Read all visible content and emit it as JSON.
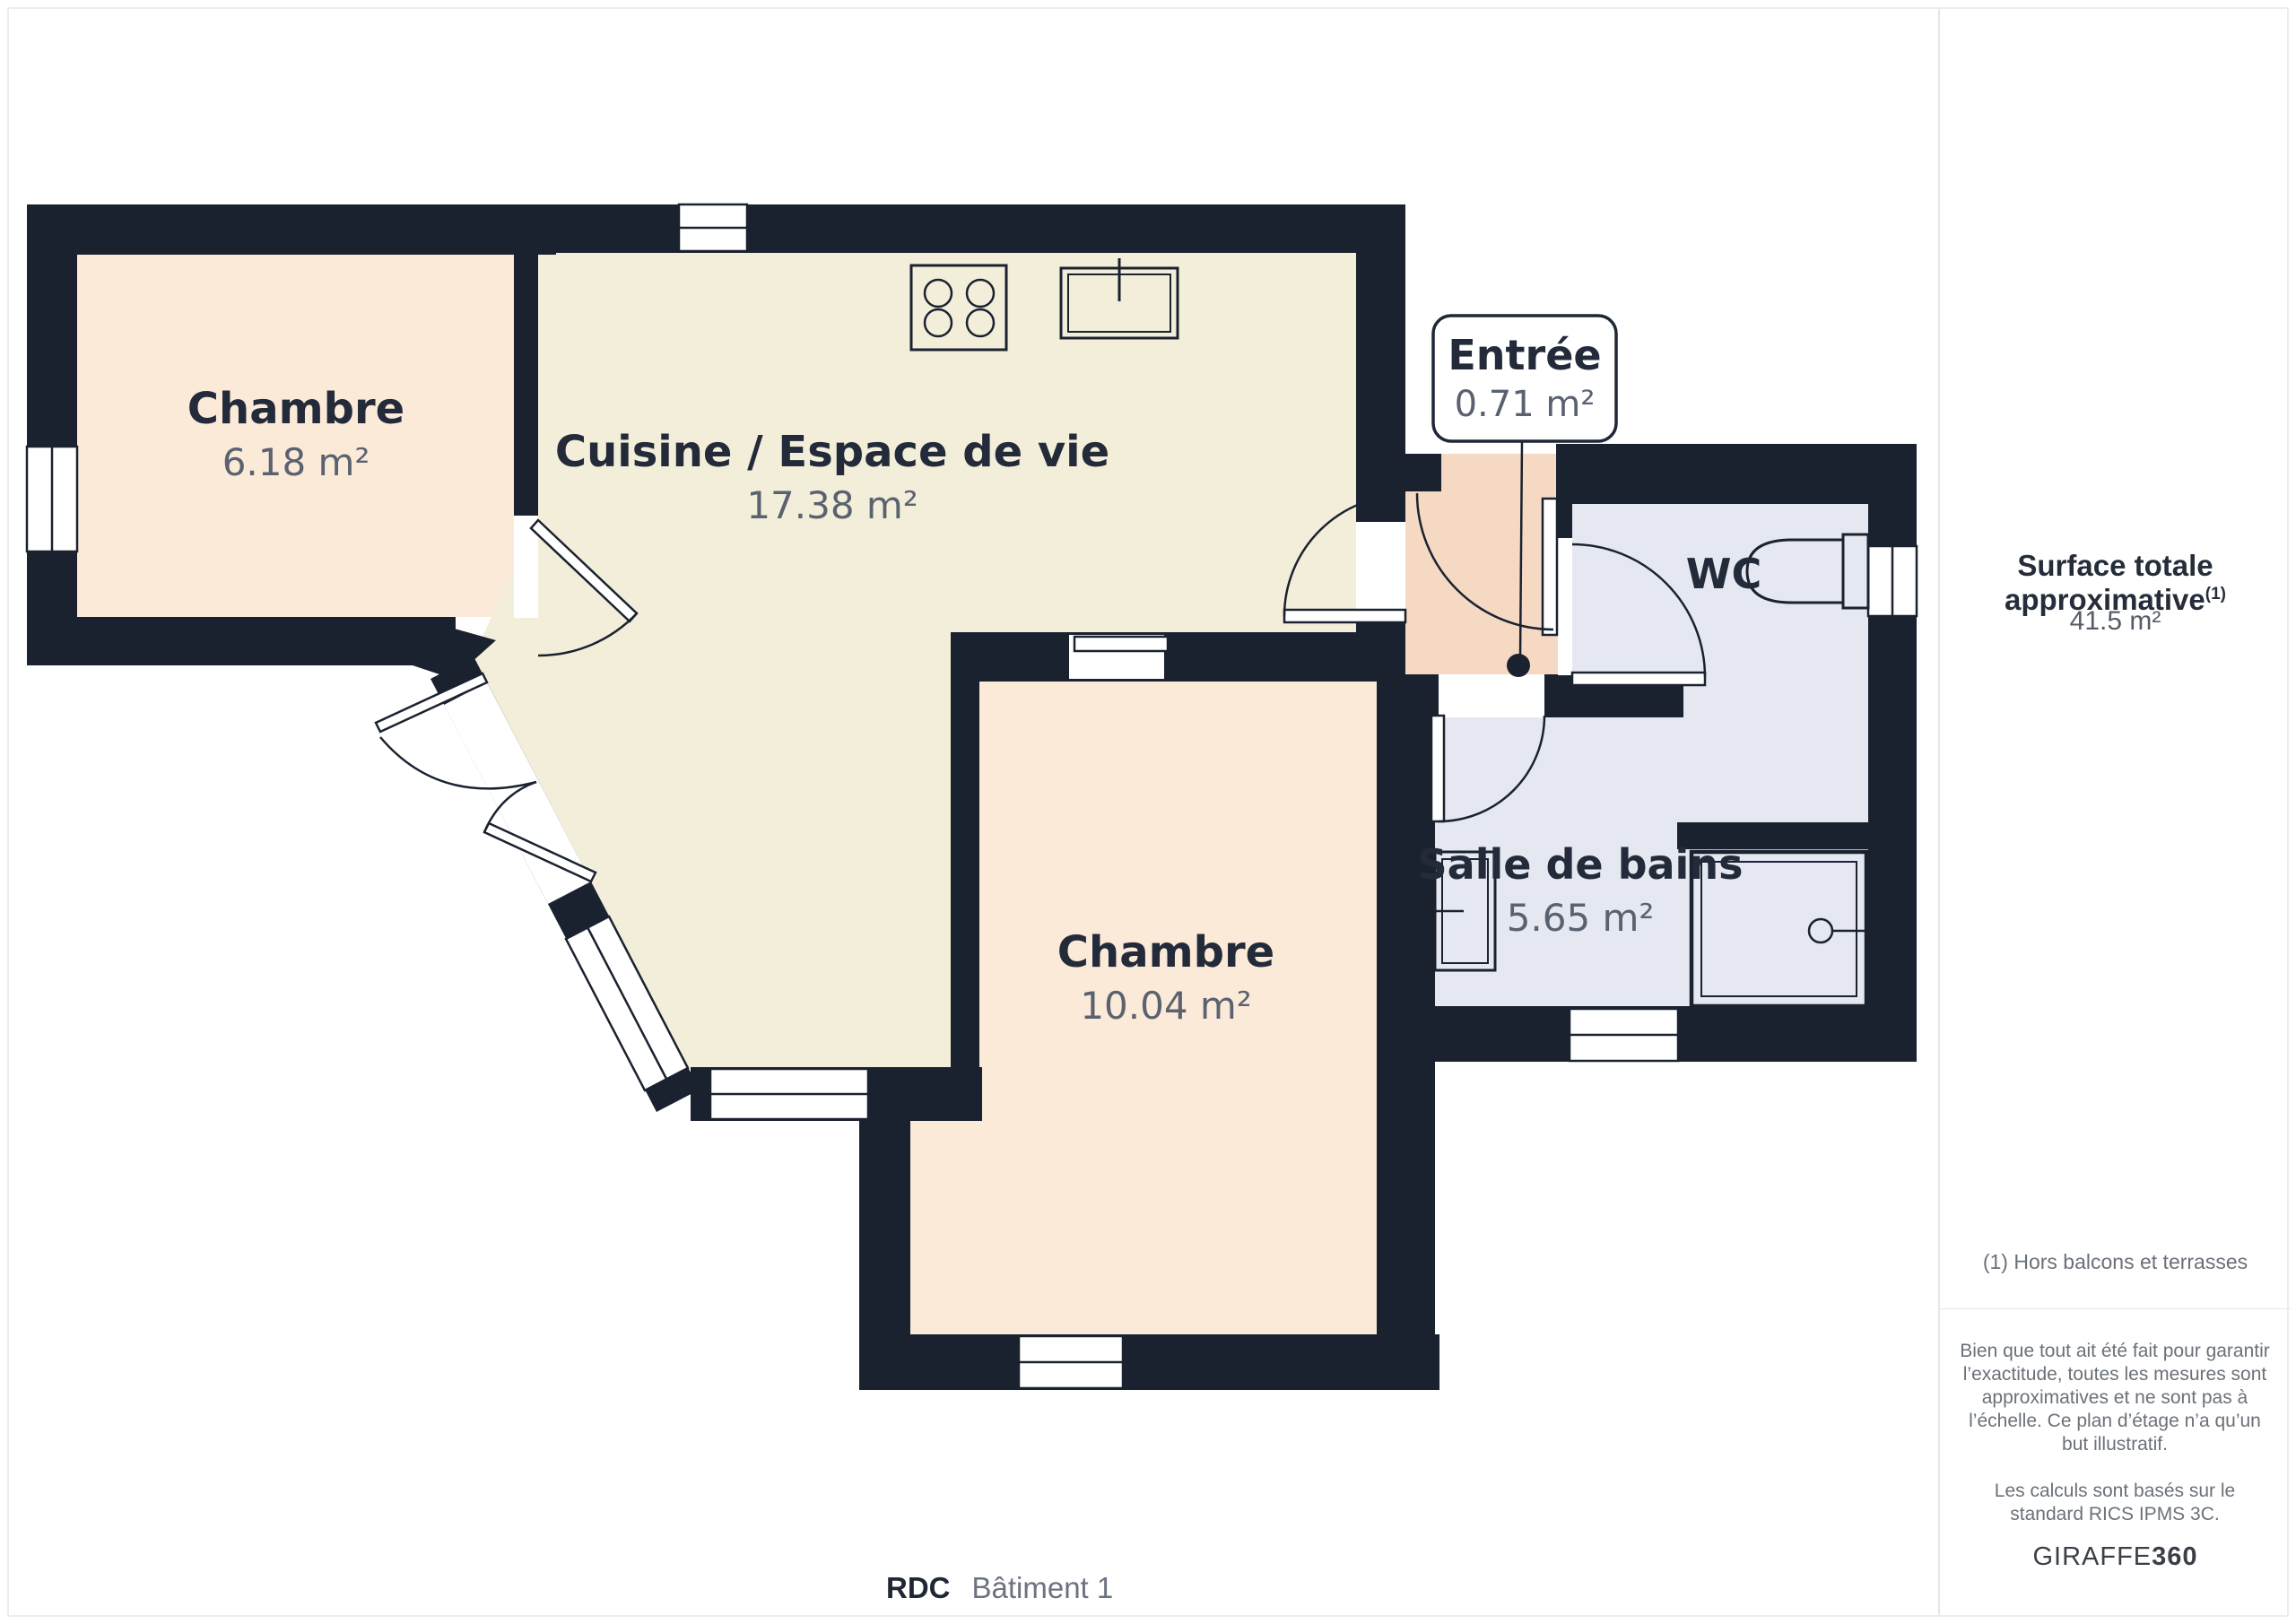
{
  "plan": {
    "floor_label": "RDC",
    "building_label": "Bâtiment 1",
    "rooms": [
      {
        "key": "chambre-1",
        "name": "Chambre",
        "area": "6.18 m²"
      },
      {
        "key": "cuisine-espace-de-vie",
        "name": "Cuisine / Espace de vie",
        "area": "17.38 m²"
      },
      {
        "key": "chambre-2",
        "name": "Chambre",
        "area": "10.04 m²"
      },
      {
        "key": "entree",
        "name": "Entrée",
        "area": "0.71 m²"
      },
      {
        "key": "wc",
        "name": "WC",
        "area": ""
      },
      {
        "key": "salle-de-bains",
        "name": "Salle de bains",
        "area": "5.65 m²"
      }
    ],
    "colors": {
      "wall": "#1a2230",
      "bedroom_floor": "#fcead9",
      "living_floor": "#f3eeda",
      "entry_floor": "#f6d9c3",
      "bathroom_floor": "#e5e8f1",
      "title_text": "#232a39",
      "area_text": "#5a6270"
    }
  },
  "sidebar": {
    "surface_title": "Surface totale approximative",
    "surface_note_ref": "(1)",
    "surface_value": "41.5 m²",
    "footnote": "(1) Hors balcons et terrasses",
    "disclaimer": "Bien que tout ait été fait pour garantir l’exactitude, toutes les mesures sont approximatives et ne sont pas à l’échelle. Ce plan d’étage n’a qu’un but illustratif.",
    "standard": "Les calculs sont basés sur le standard RICS IPMS 3C.",
    "brand_name": "GIRAFFE",
    "brand_suffix": "360"
  }
}
